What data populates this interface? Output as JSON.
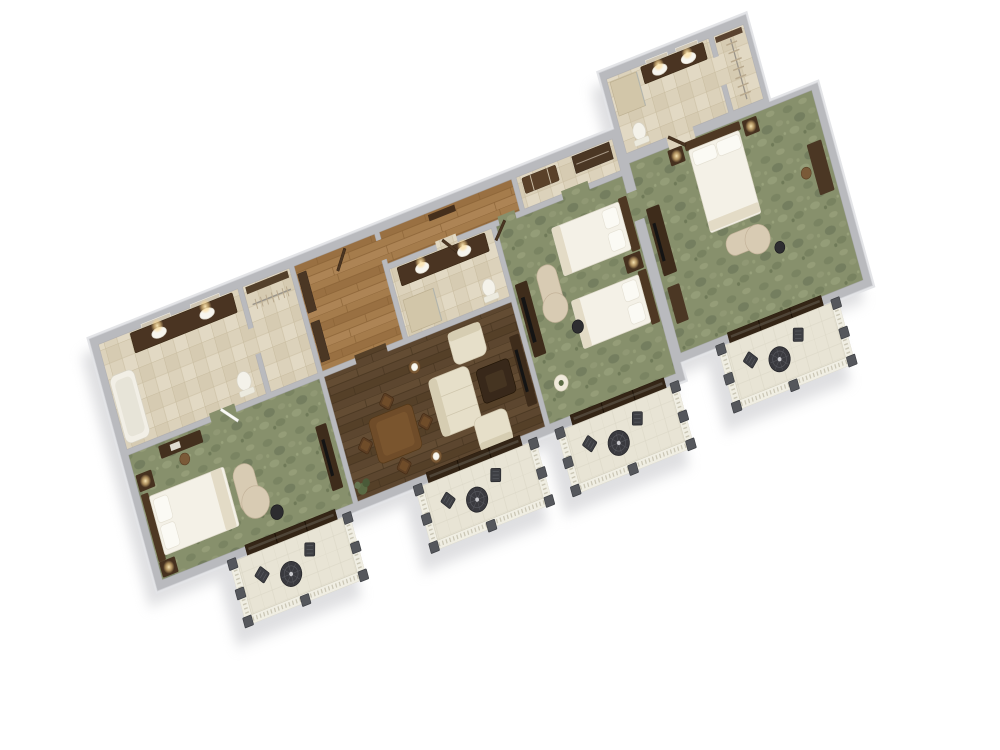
{
  "scene": {
    "title": "3D isometric floor plan rendering of a three-bedroom suite with four balconies",
    "background_color": "#ffffff",
    "view": "top-down axonometric, plan rotated about 26 degrees, long axis rising to the right"
  },
  "palette": {
    "wall_top": "#b9babe",
    "wall_outer_face": "#e3e4e7",
    "carpet_green": "#87906c",
    "wood_dark": "#5c462f",
    "wood_light": "#a57c4c",
    "tile_cream": "#dcd2bb",
    "balcony_floor": "#e8e4d5",
    "cabinet_brown": "#4a3422",
    "bedding_white": "#f4f1e7",
    "upholstery_cream": "#e6dfc9",
    "chaise_tan": "#d8cbb3",
    "patio_metal": "#3e3f44",
    "lamp_glow": "#ffe7b0",
    "shadow": "#c4c5c9"
  },
  "rooms": [
    {
      "id": "master-bathroom",
      "label": "Master bathroom",
      "floor": "cream tile",
      "features": [
        "double vanity with two mirrors",
        "bathtub",
        "toilet"
      ]
    },
    {
      "id": "master-closet",
      "label": "Master closet",
      "floor": "cream tile",
      "features": [
        "shelf",
        "hanging rod with hangers"
      ]
    },
    {
      "id": "entry-hall",
      "label": "Entry hall",
      "floor": "light wood",
      "features": [
        "entry door",
        "two dark closets"
      ]
    },
    {
      "id": "corridor",
      "label": "Back corridor",
      "floor": "light wood",
      "features": [
        "console table"
      ]
    },
    {
      "id": "bathroom-2",
      "label": "Bathroom 2",
      "floor": "cream tile",
      "features": [
        "double vanity",
        "shower",
        "toilet"
      ]
    },
    {
      "id": "dressing-area",
      "label": "Dressing area",
      "floor": "cream tile",
      "features": [
        "wardrobe",
        "luggage bench"
      ]
    },
    {
      "id": "master-bedroom",
      "label": "Master bedroom",
      "floor": "green carpet",
      "features": [
        "king bed",
        "two nightstands with lamps",
        "chaise lounge with side table",
        "desk with chair",
        "TV console"
      ]
    },
    {
      "id": "living-room",
      "label": "Living room",
      "floor": "dark wood",
      "features": [
        "dining table with four chairs",
        "sofa",
        "two armchairs",
        "coffee table",
        "two lamp tables",
        "TV console",
        "plant"
      ]
    },
    {
      "id": "bedroom-2",
      "label": "Bedroom 2",
      "floor": "green carpet",
      "features": [
        "two double beds",
        "shared nightstand with lamp",
        "chaise lounge",
        "TV dresser",
        "round table"
      ]
    },
    {
      "id": "bedroom-3",
      "label": "Bedroom 3",
      "floor": "green carpet",
      "features": [
        "king bed",
        "two nightstands with lamps",
        "chaise lounge",
        "TV armoire",
        "dresser",
        "desk with chair"
      ]
    },
    {
      "id": "bathroom-3",
      "label": "Bathroom 3",
      "floor": "cream tile",
      "features": [
        "double vanity with two mirrors",
        "shower",
        "toilet"
      ]
    },
    {
      "id": "closet-3",
      "label": "Walk-in closet",
      "floor": "cream tile",
      "features": [
        "hanging rod with hangers",
        "shelf"
      ]
    }
  ],
  "balconies": [
    {
      "id": "balcony-1",
      "label": "Balcony off master bedroom",
      "furniture": [
        "two patio chairs",
        "round mesh table"
      ]
    },
    {
      "id": "balcony-2",
      "label": "Balcony off living room",
      "furniture": [
        "two patio chairs",
        "round mesh table"
      ]
    },
    {
      "id": "balcony-3",
      "label": "Balcony off bedroom 2",
      "furniture": [
        "two patio chairs",
        "round mesh table"
      ]
    },
    {
      "id": "balcony-4",
      "label": "Balcony off bedroom 3",
      "furniture": [
        "two patio chairs",
        "round mesh table"
      ]
    }
  ]
}
